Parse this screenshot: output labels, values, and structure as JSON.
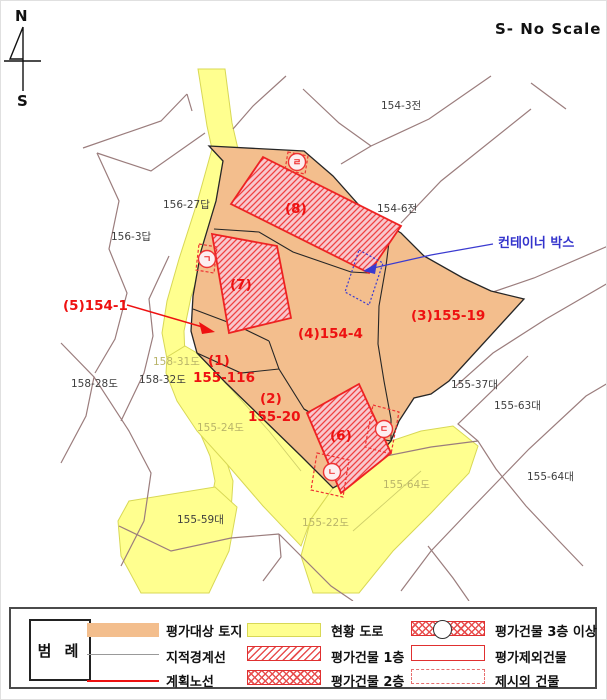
{
  "page": {
    "title": "S- No Scale"
  },
  "compass": {
    "north": "N",
    "south": "S"
  },
  "map": {
    "labels": [
      {
        "name": "label-parcel-5-154-1",
        "text": "(5)154-1",
        "cls": "red",
        "x": 62,
        "y": 309
      },
      {
        "name": "label-building-8",
        "text": "(8)",
        "cls": "red",
        "x": 284,
        "y": 212
      },
      {
        "name": "label-building-7",
        "text": "(7)",
        "cls": "red",
        "x": 229,
        "y": 288
      },
      {
        "name": "label-building-6",
        "text": "(6)",
        "cls": "red",
        "x": 329,
        "y": 439
      },
      {
        "name": "label-parcel-4-154-4",
        "text": "(4)154-4",
        "cls": "red",
        "x": 297,
        "y": 337
      },
      {
        "name": "label-parcel-3-155-19",
        "text": "(3)155-19",
        "cls": "red",
        "x": 410,
        "y": 319
      },
      {
        "name": "label-parcel-1-no",
        "text": "(1)",
        "cls": "red",
        "x": 207,
        "y": 364
      },
      {
        "name": "label-parcel-1-lot",
        "text": "155-116",
        "cls": "red",
        "x": 192,
        "y": 381
      },
      {
        "name": "label-parcel-2-no",
        "text": "(2)",
        "cls": "red",
        "x": 259,
        "y": 402
      },
      {
        "name": "label-parcel-2-lot",
        "text": "155-20",
        "cls": "red",
        "x": 247,
        "y": 420
      },
      {
        "name": "label-parcel-154-3",
        "text": "154-3전",
        "cls": "gray",
        "x": 380,
        "y": 108
      },
      {
        "name": "label-parcel-154-6",
        "text": "154-6전",
        "cls": "gray",
        "x": 376,
        "y": 211
      },
      {
        "name": "label-parcel-156-27",
        "text": "156-27답",
        "cls": "gray",
        "x": 162,
        "y": 207
      },
      {
        "name": "label-parcel-156-3",
        "text": "156-3답",
        "cls": "gray",
        "x": 110,
        "y": 239
      },
      {
        "name": "label-parcel-158-28",
        "text": "158-28도",
        "cls": "gray",
        "x": 70,
        "y": 386
      },
      {
        "name": "label-parcel-158-32",
        "text": "158-32도",
        "cls": "gray",
        "x": 138,
        "y": 382
      },
      {
        "name": "label-parcel-155-37",
        "text": "155-37대",
        "cls": "gray",
        "x": 450,
        "y": 387
      },
      {
        "name": "label-parcel-155-63",
        "text": "155-63대",
        "cls": "gray",
        "x": 493,
        "y": 408
      },
      {
        "name": "label-parcel-155-64b",
        "text": "155-64대",
        "cls": "gray",
        "x": 526,
        "y": 479
      },
      {
        "name": "label-parcel-155-59",
        "text": "155-59대",
        "cls": "gray",
        "x": 176,
        "y": 522
      },
      {
        "name": "label-parcel-158-31",
        "text": "158-31도",
        "cls": "faint",
        "x": 152,
        "y": 364
      },
      {
        "name": "label-parcel-155-24",
        "text": "155-24도",
        "cls": "faint",
        "x": 196,
        "y": 430
      },
      {
        "name": "label-parcel-155-64",
        "text": "155-64도",
        "cls": "faint",
        "x": 382,
        "y": 487
      },
      {
        "name": "label-parcel-155-22",
        "text": "155-22도",
        "cls": "faint",
        "x": 301,
        "y": 525
      },
      {
        "name": "label-container-box",
        "text": "컨테이너 박스",
        "cls": "blue",
        "x": 497,
        "y": 246
      }
    ],
    "circle_marks": [
      {
        "name": "mark-giyeok",
        "letter": "ㄱ",
        "cx": 206,
        "cy": 258
      },
      {
        "name": "mark-nieun",
        "letter": "ㄴ",
        "cx": 331,
        "cy": 471
      },
      {
        "name": "mark-digeut",
        "letter": "ㄷ",
        "cx": 383,
        "cy": 428
      },
      {
        "name": "mark-rieul",
        "letter": "ㄹ",
        "cx": 296,
        "cy": 161
      }
    ]
  },
  "legend": {
    "title": "범 례",
    "items": [
      {
        "label": "평가대상 토지"
      },
      {
        "label": "지적경계선"
      },
      {
        "label": "계획노선"
      },
      {
        "label": "현황 도로"
      },
      {
        "label": "평가건물 1층"
      },
      {
        "label": "평가건물 2층"
      },
      {
        "label": "평가건물 3층 이상"
      },
      {
        "label": "평가제외건물"
      },
      {
        "label": "제시외 건물"
      }
    ]
  },
  "colors": {
    "target_land_orange": "#F3BE8D",
    "road_yellow": "#FFFF8F",
    "building_pink": "#F8C8CE",
    "appraisal_red": "#EE1111",
    "cadastral_brown": "#9B7D7D",
    "note_blue": "#3333CC"
  }
}
